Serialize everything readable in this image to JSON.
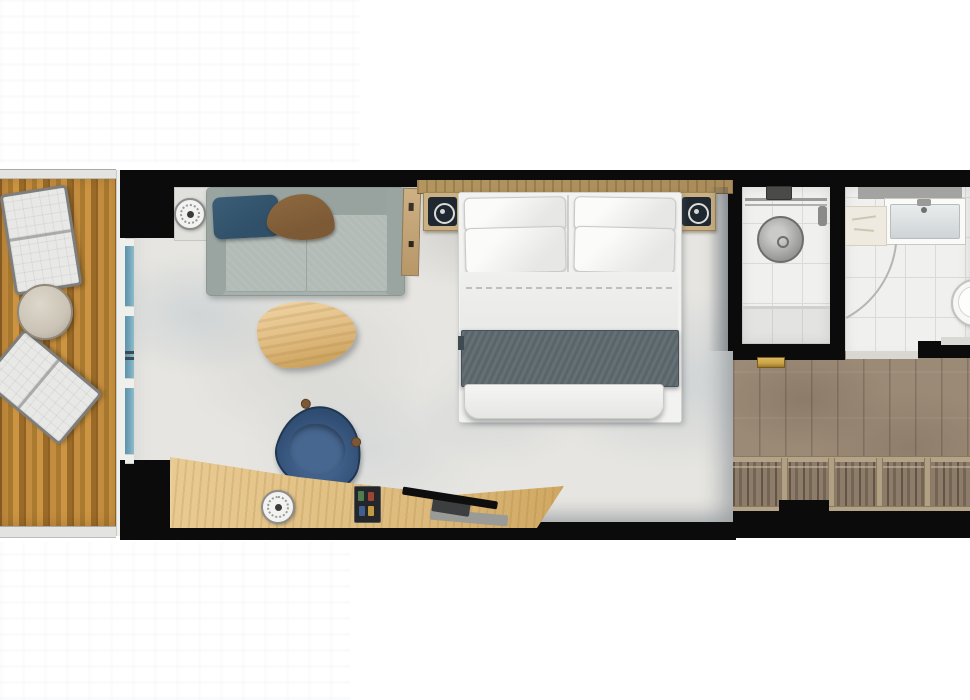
{
  "scene": {
    "title": "Cabin floor plan, top-down view",
    "canvas": {
      "width": 970,
      "height": 700
    },
    "orientation": "balcony-left, entry-right"
  },
  "rooms": [
    {
      "id": "balcony",
      "furniture": [
        "lounge-chair",
        "lounge-chair",
        "round-side-table",
        "wood-deck",
        "railing"
      ]
    },
    {
      "id": "living-sleeping-area",
      "furniture": [
        "sofa",
        "navy-pillow",
        "brown-pillow",
        "side-table-with-lamp",
        "valet-shelf",
        "coffee-table",
        "desk",
        "desk-lamp",
        "minibar-tray",
        "wall-tv",
        "desk-chair",
        "double-bed",
        "four-pillows",
        "gray-throw",
        "headboard",
        "nightstand-with-lamp",
        "nightstand-with-lamp",
        "area-rug"
      ]
    },
    {
      "id": "shower-room",
      "furniture": [
        "rain-shower-head",
        "shower-rail",
        "shower-control",
        "hand-shower",
        "tiled-floor"
      ]
    },
    {
      "id": "bathroom",
      "furniture": [
        "vanity-sink",
        "faucet",
        "shelf",
        "door-swing-arc",
        "toilet"
      ]
    },
    {
      "id": "entry-hallway",
      "furniture": [
        "wood-floor",
        "wardrobe-hanging-clothes",
        "wardrobe-dividers",
        "entry-door-recess",
        "gold-threshold"
      ]
    }
  ],
  "colors": {
    "wall": "#0b0b0b",
    "deck_light": "#c48c3e",
    "deck_dark": "#8f6224",
    "railing": "#e3e3e1",
    "glass": "#74a7bc",
    "frame_white": "#efefec",
    "rug_base": "#e6e5e1",
    "sofa_body": "#a6b0ac",
    "sofa_seat": "#b3bbb7",
    "pillow_navy": "#2f5068",
    "pillow_brown": "#7c5a36",
    "coffee_table": "#dfba7e",
    "chair_navy": "#2e4b70",
    "desk_wood": "#ddbb7d",
    "headboard": "#a98c5a",
    "nightstand": "#cbb084",
    "lamp_dark": "#1f2730",
    "bed_white": "#f2f2f0",
    "throw": "#59656b",
    "tile": "#f0f0ee",
    "grout": "#dcdad6",
    "fixture": "#8e8e8c",
    "hall_wood": "#9b8a76",
    "closet_clothes": "#8d7c6a",
    "closet_divider": "#b2a085",
    "gold": "#c9a348",
    "balcony_table": "#cbc4b6"
  }
}
